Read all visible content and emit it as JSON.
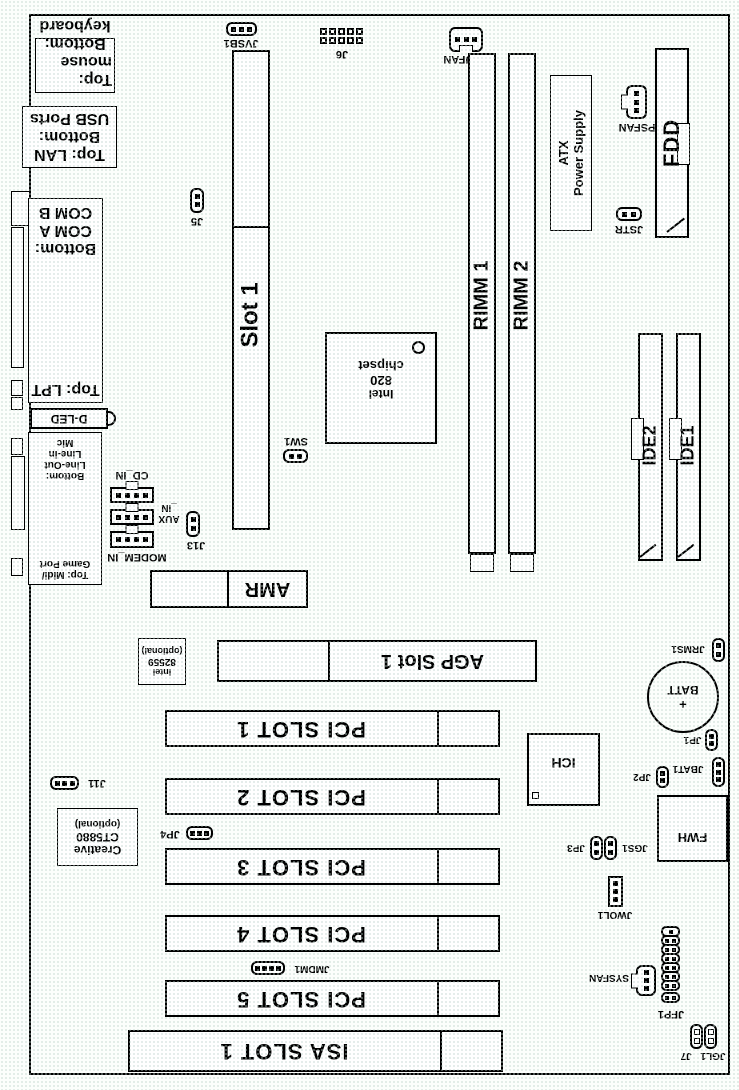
{
  "rear_io": {
    "mouse_keyboard": {
      "line1": "Top: mouse",
      "line2": "Bottom:",
      "line3": "keyboard"
    },
    "lan_usb": {
      "line1": "Top: LAN",
      "line2": "Bottom:",
      "line3": "USB Ports"
    },
    "lpt_com": {
      "line1": "Top: LPT",
      "line2": "Bottom:",
      "line3": "COM A",
      "line4": "COM B"
    },
    "dled": "D-LED",
    "midi_audio": {
      "line1": "Top: Midi/",
      "line2": "Game Port",
      "line3": "Bottom:",
      "line4": "Line-Out",
      "line5": "Line-in",
      "line6": "Mic"
    }
  },
  "cpu_area": {
    "jvsb1": "JVSB1",
    "j6": "J6",
    "cpufan": "CPUFAN",
    "slot1": "Slot 1",
    "j5": "J5",
    "sw1": "SW1"
  },
  "memory": {
    "rimm1": "RIMM 1",
    "rimm2": "RIMM 2"
  },
  "power": {
    "atx_line1": "ATX",
    "atx_line2": "Power Supply",
    "psfan": "PSFAN",
    "jstr": "JSTR"
  },
  "storage": {
    "fdd": "FDD",
    "ide2": "IDE2",
    "ide1": "IDE1"
  },
  "chipset": {
    "line1": "Intel",
    "line2": "820",
    "line3": "chipset"
  },
  "audio": {
    "cd_in": "CD_IN",
    "aux_line1": "AUX",
    "aux_line2": "_IN",
    "modem_in": "MODEM_IN",
    "j13": "J13",
    "amr": "AMR",
    "j11": "J11",
    "jp4": "JP4",
    "jmdm1": "JMDM1",
    "codec": {
      "line1": "Creative",
      "line2": "CT5880",
      "line3": "(optional)"
    }
  },
  "lan_chip": {
    "line1": "Intel",
    "line2": "82559",
    "line3": "(optional)"
  },
  "expansion": {
    "agp": "AGP Slot 1",
    "pci1": "PCI SLOT 1",
    "pci2": "PCI SLOT 2",
    "pci3": "PCI SLOT 3",
    "pci4": "PCI SLOT 4",
    "pci5": "PCI SLOT 5",
    "isa": "ISA SLOT 1"
  },
  "south": {
    "ich": "ICH",
    "fwh": "FWH",
    "battery_plus": "+",
    "battery": "BATT",
    "jrms1": "JRMS1",
    "jp1": "JP1",
    "jp2": "JP2",
    "jbat1": "JBAT1",
    "jp3": "JP3",
    "jgs1": "JGS1",
    "jwol1": "JWOL1",
    "sysfan": "SYSFAN",
    "jfp1": "JFP1",
    "jgl1_j7": "JGL1 J7"
  }
}
